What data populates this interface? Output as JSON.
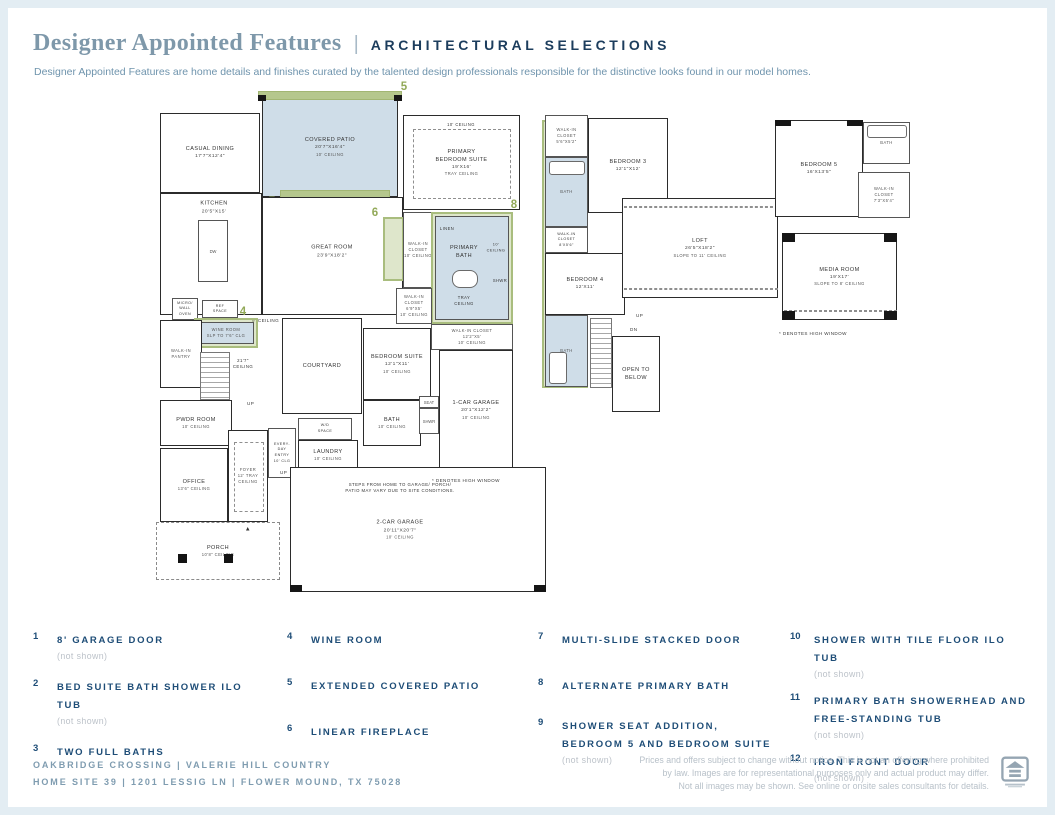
{
  "header": {
    "title": "Designer Appointed Features",
    "divider": "|",
    "subtitle": "ARCHITECTURAL SELECTIONS",
    "description": "Designer Appointed Features are home details and finishes curated by the talented design professionals responsible for the distinctive looks found in our model homes."
  },
  "colors": {
    "accent_green": "#92a958",
    "plan_blue": "#cfdde8",
    "navy": "#1e4d77",
    "title_blue": "#7e98aa"
  },
  "markers": {
    "m3": "3",
    "m4": "4",
    "m5": "5",
    "m6": "6",
    "m7": "7",
    "m8": "8"
  },
  "plan1": {
    "casual_dining": {
      "l1": "CASUAL DINING",
      "l2": "17'7\"X12'4\""
    },
    "kitchen": {
      "l1": "KITCHEN",
      "l2": "20'5\"X15'"
    },
    "dw": "DW",
    "covered_patio": {
      "l1": "COVERED PATIO",
      "l2": "20'7\"X16'4\"",
      "l3": "10' CEILING"
    },
    "great_room": {
      "l1": "GREAT ROOM",
      "l2": "23'9\"X18'2\""
    },
    "primary_bedroom": {
      "l0": "10' CEILING",
      "l1": "PRIMARY",
      "l2": "BEDROOM SUITE",
      "l3": "19'X16'",
      "l4": "TRAY CEILING"
    },
    "wic_primary": {
      "l1": "WALK-IN",
      "l2": "CLOSET",
      "l3": "10' CEILING"
    },
    "linen": "LINEN",
    "primary_bath": {
      "l1": "PRIMARY",
      "l2": "BATH",
      "ceiling1": "10'",
      "ceiling2": "CEILING",
      "shwr": "SHWR",
      "tray1": "TRAY",
      "tray2": "CEILING"
    },
    "wic_69": {
      "l1": "WALK-IN",
      "l2": "CLOSET",
      "l3": "6'9\"X5'",
      "l4": "10' CEILING"
    },
    "wic_122": {
      "l1": "WALK-IN CLOSET",
      "l2": "12'2\"X5'",
      "l3": "10' CEILING"
    },
    "micro": {
      "l1": "MICRO/",
      "l2": "WALL",
      "l3": "OVEN"
    },
    "ref": {
      "l1": "REF",
      "l2": "SPACE"
    },
    "ceiling9": "9' CEILING",
    "wine_room": {
      "l1": "WINE ROOM",
      "l2": "SLP TO 7'6\" CLG"
    },
    "pantry": {
      "l1": "WALK-IN",
      "l2": "PANTRY"
    },
    "stair_ceiling": {
      "l1": "21'7\"",
      "l2": "CEILING"
    },
    "up": "UP",
    "courtyard": "COURTYARD",
    "pwdr": {
      "l1": "PWDR ROOM",
      "l2": "10' CEILING"
    },
    "bedroom_suite": {
      "l1": "BEDROOM SUITE",
      "l2": "12'1\"X11'",
      "l3": "10' CEILING"
    },
    "bath_suite": {
      "l1": "BATH",
      "l2": "10' CEILING"
    },
    "seat": "SEAT",
    "shwr": "SHWR",
    "garage1": {
      "l1": "1-CAR GARAGE",
      "l2": "20'1\"X12'2\"",
      "l3": "10' CEILING"
    },
    "everyday": {
      "l1": "EVERY-",
      "l2": "DAY",
      "l3": "ENTRY",
      "l4": "10' CLG"
    },
    "wd": {
      "l1": "W/D",
      "l2": "SPACE"
    },
    "laundry": {
      "l1": "LAUNDRY",
      "l2": "10' CEILING"
    },
    "foyer": {
      "l1": "FOYER",
      "l2": "12' TRAY",
      "l3": "CEILING"
    },
    "office": {
      "l1": "OFFICE",
      "l2": "13'6\" CEILING"
    },
    "steps_note": {
      "l1": "STEPS FROM HOME TO GARAGE/ PORCH/",
      "l2": "PATIO MAY VARY DUE TO SITE CONDITIONS."
    },
    "garage2": {
      "l1": "2-CAR GARAGE",
      "l2": "20'11\"X20'7\"",
      "l3": "10' CEILING"
    },
    "porch": {
      "l1": "PORCH",
      "l2": "10'8\" CEILING"
    },
    "door_marker": "▲",
    "denotes": "* DENOTES HIGH WINDOW"
  },
  "plan2": {
    "wic3": {
      "l1": "WALK-IN",
      "l2": "CLOSET",
      "l3": "5'6\"X5'2\""
    },
    "bedroom3": {
      "l1": "BEDROOM 3",
      "l2": "12'1\"X12'"
    },
    "bath_upper": "BATH",
    "wic4": {
      "l1": "WALK-IN",
      "l2": "CLOSET",
      "l3": "8'X5'6\""
    },
    "bedroom4": {
      "l1": "BEDROOM 4",
      "l2": "12'X11'"
    },
    "bath_lower": "BATH",
    "up": "UP",
    "dn": "DN",
    "open_below": {
      "l1": "OPEN TO",
      "l2": "BELOW"
    },
    "loft": {
      "l1": "LOFT",
      "l2": "26'5\"X18'2\"",
      "l3": "SLOPE TO 11' CEILING"
    },
    "bedroom5": {
      "l1": "BEDROOM 5",
      "l2": "16'X13'5\""
    },
    "bath5": "BATH",
    "wic5": {
      "l1": "WALK-IN",
      "l2": "CLOSET",
      "l3": "7'3\"X5'4\""
    },
    "media": {
      "l1": "MEDIA ROOM",
      "l2": "19'X17'",
      "l3": "SLOPE TO 8' CEILING"
    },
    "denotes": "* DENOTES HIGH WINDOW"
  },
  "legend": {
    "items": [
      {
        "num": "1",
        "label": "8' GARAGE DOOR",
        "note": "(not shown)"
      },
      {
        "num": "2",
        "label": "BED SUITE BATH SHOWER ILO TUB",
        "note": "(not shown)"
      },
      {
        "num": "3",
        "label": "TWO FULL BATHS",
        "note": ""
      },
      {
        "num": "4",
        "label": "WINE ROOM",
        "note": ""
      },
      {
        "num": "5",
        "label": "EXTENDED COVERED PATIO",
        "note": ""
      },
      {
        "num": "6",
        "label": "LINEAR FIREPLACE",
        "note": ""
      },
      {
        "num": "7",
        "label": "MULTI-SLIDE STACKED DOOR",
        "note": ""
      },
      {
        "num": "8",
        "label": "ALTERNATE PRIMARY BATH",
        "note": ""
      },
      {
        "num": "9",
        "label": "SHOWER SEAT ADDITION, BEDROOM 5 AND BEDROOM SUITE",
        "note": "(not shown)"
      },
      {
        "num": "10",
        "label": "SHOWER WITH TILE FLOOR ILO TUB",
        "note": "(not shown)"
      },
      {
        "num": "11",
        "label": "PRIMARY BATH SHOWERHEAD AND FREE-STANDING TUB",
        "note": "(not shown)"
      },
      {
        "num": "12",
        "label": "IRON FRONT DOOR",
        "note": "(not shown)"
      }
    ]
  },
  "footer": {
    "community_line1": "OAKBRIDGE CROSSING  |  VALERIE HILL COUNTRY",
    "community_line2": "HOME SITE 39  |  1201 LESSIG LN  |  FLOWER MOUND, TX 75028",
    "disclaimer_line1": "Prices and offers subject to change without notice. This is not an offering where prohibited",
    "disclaimer_line2": "by law. Images are for representational purposes only and actual product may differ.",
    "disclaimer_line3": "Not all images may be shown. See online or onsite sales consultants for details.",
    "eho_icon": "equal-housing-opportunity-logo"
  }
}
